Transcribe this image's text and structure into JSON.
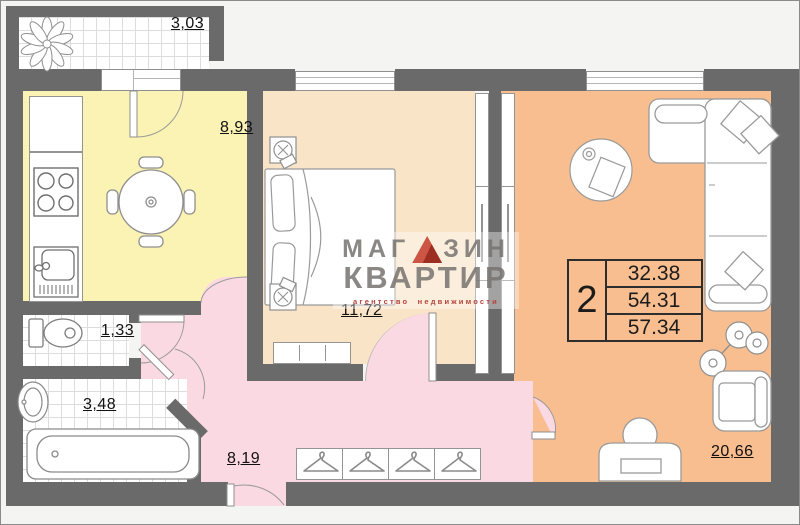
{
  "watermark": {
    "brand_top_left": "МАГ",
    "brand_top_right": "ЗИН",
    "brand_bottom": "КВАРТИР",
    "tagline": "агентство недвижимости",
    "accent_color": "#a93226"
  },
  "info_table": {
    "rooms_count": "2",
    "areas": [
      "32.38",
      "54.31",
      "57.34"
    ]
  },
  "rooms": {
    "balcony": {
      "label": "3,03"
    },
    "kitchen": {
      "label": "8,93"
    },
    "bedroom": {
      "label": "11,72"
    },
    "toilet": {
      "label": "1,33"
    },
    "bathroom": {
      "label": "3,48"
    },
    "hall": {
      "label": "8,19"
    },
    "living": {
      "label": "20,66"
    }
  },
  "colors": {
    "wall": "#6a6a6a",
    "kitchen_floor": "#fbf3b3",
    "bedroom_floor": "#fae4c8",
    "living_floor": "#f9be8f",
    "hall_floor": "#fbd9e2",
    "tile_floor": "#ffffff",
    "watermark_red": "#a93226"
  },
  "icons": [
    "plant-icon",
    "stove-icon",
    "kitchen-sink-icon",
    "dining-table-icon",
    "bed-icon",
    "tv-icon",
    "dresser-icon",
    "wardrobe-icon",
    "corner-sofa-icon",
    "coffee-table-icon",
    "floor-lamp-icon",
    "armchair-icon",
    "desk-chair-icon",
    "hanger-icon",
    "toilet-icon",
    "washbasin-icon",
    "bathtub-icon"
  ]
}
